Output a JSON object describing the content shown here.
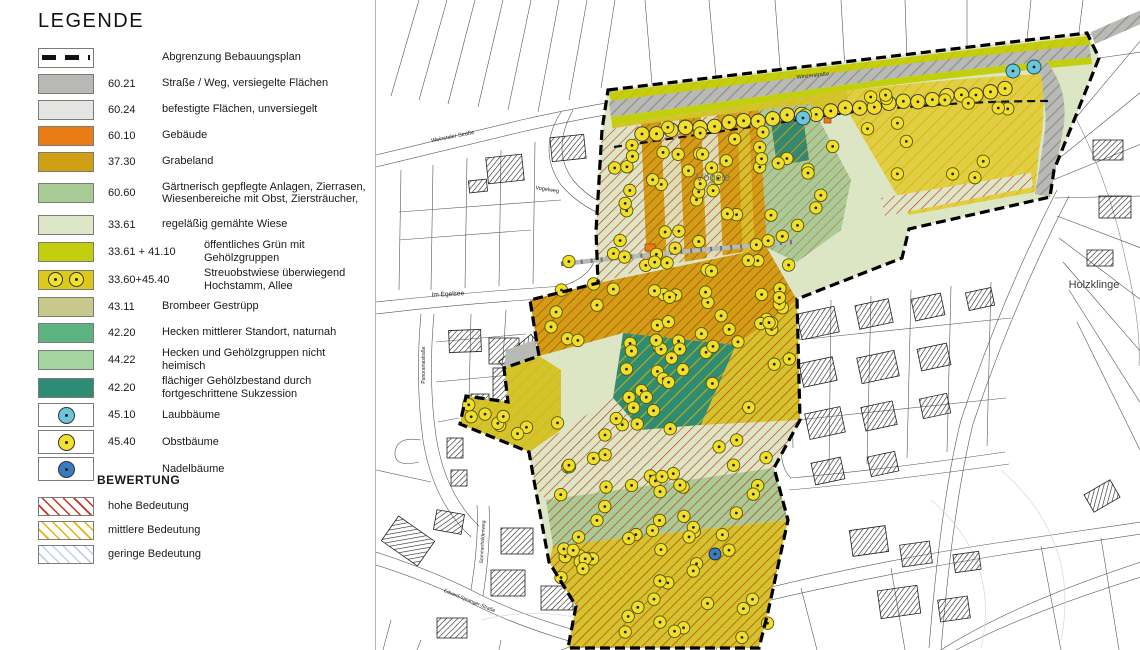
{
  "legend": {
    "title": "LEGENDE",
    "items": [
      {
        "code": "",
        "label": "Abgrenzung Bebauungsplan",
        "swatch": "boundary",
        "color": "#ffffff"
      },
      {
        "code": "60.21",
        "label": "Straße / Weg, versiegelte Flächen",
        "swatch": "fill",
        "color": "#b9b9b5"
      },
      {
        "code": "60.24",
        "label": "befestigte Flächen, unversiegelt",
        "swatch": "fill",
        "color": "#e4e4e2"
      },
      {
        "code": "60.10",
        "label": "Gebäude",
        "swatch": "fill",
        "color": "#ea7c15"
      },
      {
        "code": "37.30",
        "label": "Grabeland",
        "swatch": "fill",
        "color": "#cf9f14"
      },
      {
        "code": "60.60",
        "label": "Gärtnerisch gepflegte Anlagen, Zierrasen,",
        "label2": "Wiesenbereiche mit Obst, Ziersträucher,",
        "swatch": "fill",
        "color": "#a9cb95"
      },
      {
        "code": "33.61",
        "label": "regeläßig gemähte Wiese",
        "swatch": "fill",
        "color": "#dde7c8"
      },
      {
        "code": "33.61 + 41.10",
        "label": "öffentliches Grün mit Gehölzgruppen",
        "swatch": "fill",
        "color": "#c2cf0e"
      },
      {
        "code": "33.60+45.40",
        "label": "Streuobstwiese überwiegend Hochstamm, Allee",
        "swatch": "streuobst",
        "color": "#ddc81c"
      },
      {
        "code": "43.11",
        "label": "Brombeer Gestrüpp",
        "swatch": "fill",
        "color": "#c6c98b"
      },
      {
        "code": "42.20",
        "label": "Hecken mittlerer Standort, naturnah",
        "swatch": "fill",
        "color": "#5cb380"
      },
      {
        "code": "44.22",
        "label": "Hecken und Gehölzgruppen nicht heimisch",
        "swatch": "fill",
        "color": "#a6d4a0"
      },
      {
        "code": "42.20",
        "label": "flächiger Gehölzbestand durch fortgeschrittene Sukzession",
        "swatch": "fill",
        "color": "#2e8b74"
      },
      {
        "code": "45.10",
        "label": "Laubbäume",
        "swatch": "tree",
        "color": "#6cc5d9"
      },
      {
        "code": "45.40",
        "label": "Obstbäume",
        "swatch": "tree",
        "color": "#f0e12a"
      },
      {
        "code": "",
        "label": "Nadelbäume",
        "swatch": "tree",
        "color": "#3a7abf"
      }
    ],
    "bewertung": {
      "title": "BEWERTUNG",
      "items": [
        {
          "label": "hohe Bedeutung",
          "color": "#c8321e"
        },
        {
          "label": "mittlere Bedeutung",
          "color": "#e5b400"
        },
        {
          "label": "geringe Bedeutung",
          "color": "#bdd3e2"
        }
      ]
    }
  },
  "map": {
    "palette": {
      "road": "#b9b9b5",
      "verge": "#c2cf0e",
      "streuobst": "#d3c32c",
      "grabeland": "#cf9f14",
      "wiese": "#dce6c4",
      "garten": "#a9cb95",
      "sukzession": "#2e8b74",
      "obstbaum": "#f0de2a",
      "laubbaum": "#6cc5d9",
      "nadelbaum": "#3a7abf",
      "gebaeude": "#ea7c15"
    },
    "labels": [
      {
        "text": "Vögele",
        "x": 712,
        "y": 181,
        "rot": 0,
        "size": 11,
        "color": "#72725c"
      },
      {
        "text": "Holzklinge",
        "x": 1093,
        "y": 288,
        "rot": 0,
        "size": 11,
        "color": "#3c3c3c"
      },
      {
        "text": "Im Egelsee",
        "x": 447,
        "y": 296,
        "rot": -3,
        "size": 6.5,
        "color": "#222222"
      },
      {
        "text": "Winzerstraße",
        "x": 812,
        "y": 77,
        "rot": -6,
        "size": 5.5,
        "color": "#222222"
      },
      {
        "text": "Weinstaler Straße",
        "x": 452,
        "y": 138,
        "rot": -11,
        "size": 5.5,
        "color": "#222222"
      },
      {
        "text": "Vogelweg",
        "x": 546,
        "y": 191,
        "rot": 9,
        "size": 5.5,
        "color": "#222222"
      },
      {
        "text": "Eduard-Spranger-Straße",
        "x": 468,
        "y": 602,
        "rot": 22,
        "size": 5,
        "color": "#222222"
      },
      {
        "text": "Panoramastraße",
        "x": 424,
        "y": 365,
        "rot": -90,
        "size": 5,
        "color": "#222222"
      },
      {
        "text": "Sommerhaldenweg",
        "x": 483,
        "y": 542,
        "rot": -87,
        "size": 5,
        "color": "#222222"
      }
    ],
    "allee": {
      "x1": 641,
      "y1": 134,
      "x2": 1004,
      "y2": 90,
      "count": 26
    },
    "tree_clusters": [
      {
        "x": 610,
        "y": 135,
        "w": 32,
        "h": 135,
        "n": 9
      },
      {
        "x": 646,
        "y": 120,
        "w": 118,
        "h": 145,
        "n": 30
      },
      {
        "x": 760,
        "y": 112,
        "w": 80,
        "h": 130,
        "n": 14
      },
      {
        "x": 855,
        "y": 95,
        "w": 180,
        "h": 95,
        "n": 14
      },
      {
        "x": 548,
        "y": 255,
        "w": 240,
        "h": 95,
        "n": 36
      },
      {
        "x": 622,
        "y": 338,
        "w": 100,
        "h": 80,
        "n": 15
      },
      {
        "x": 535,
        "y": 405,
        "w": 250,
        "h": 85,
        "n": 20
      },
      {
        "x": 462,
        "y": 398,
        "w": 66,
        "h": 48,
        "n": 8
      },
      {
        "x": 548,
        "y": 470,
        "w": 230,
        "h": 70,
        "n": 16
      },
      {
        "x": 560,
        "y": 520,
        "w": 215,
        "h": 118,
        "n": 34
      },
      {
        "x": 768,
        "y": 255,
        "w": 26,
        "h": 150,
        "n": 8
      }
    ],
    "special_trees": {
      "laub": [
        [
          1012,
          71
        ],
        [
          1033,
          67
        ],
        [
          802,
          118
        ]
      ],
      "nadel": [
        [
          714,
          554
        ]
      ]
    }
  }
}
